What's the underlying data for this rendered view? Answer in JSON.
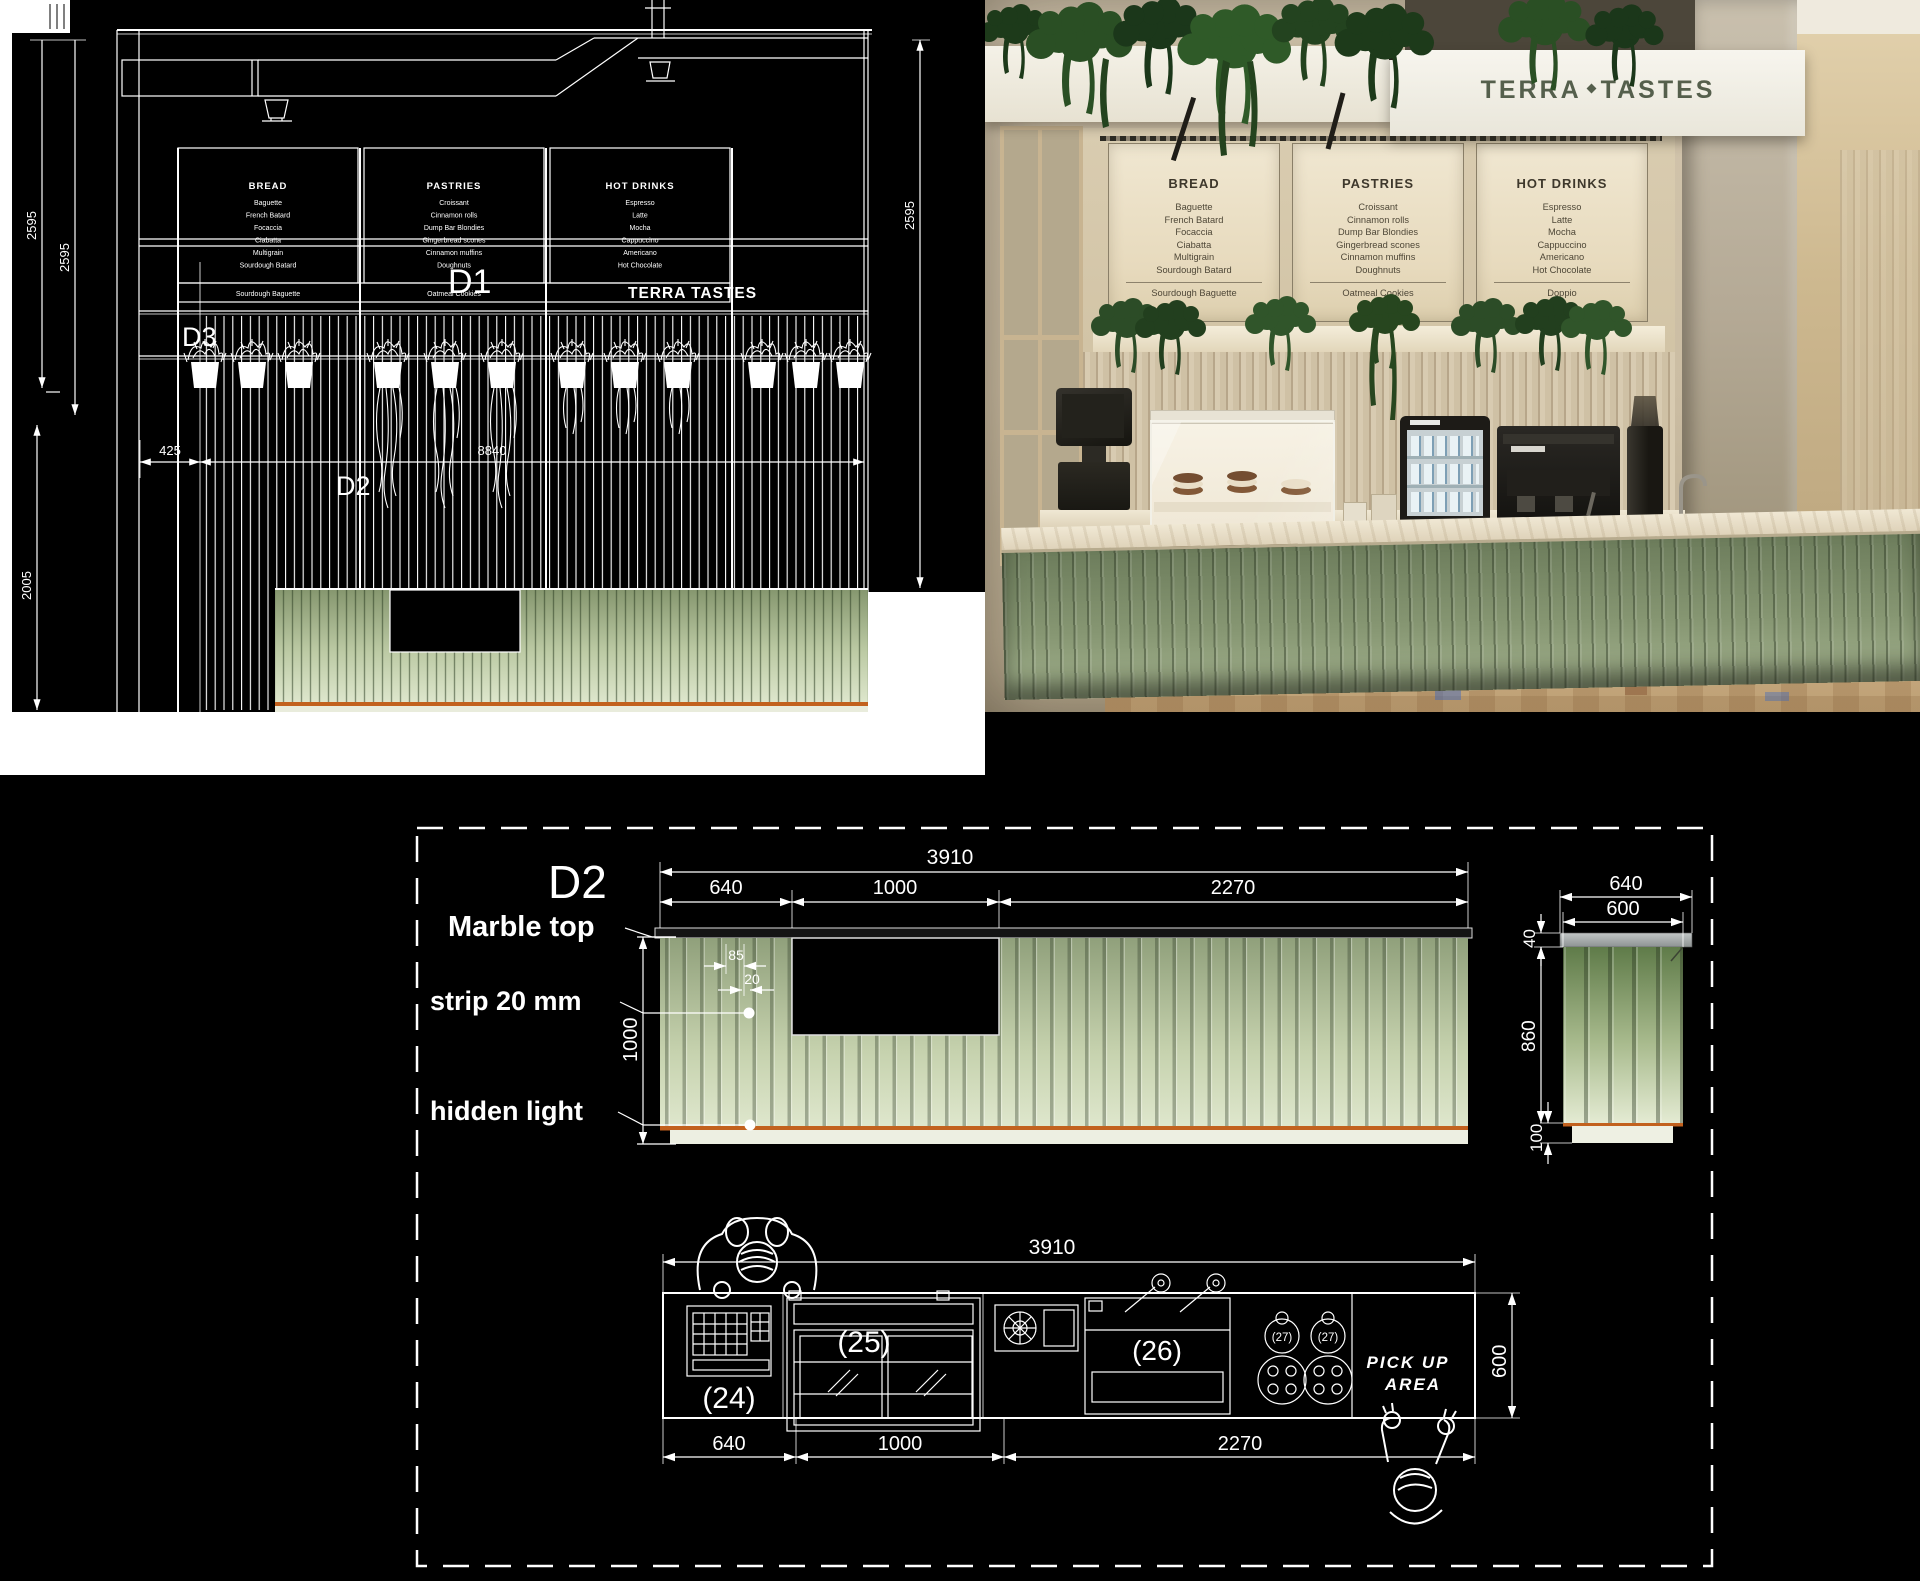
{
  "cad": {
    "brand": "TERRA TASTES",
    "labels": {
      "d1": "D1",
      "d2": "D2",
      "d3": "D3"
    },
    "dims": {
      "height_a": "2595",
      "height_b": "2595",
      "height_lower": "2005",
      "height_right": "2595",
      "offset": "425",
      "total_width": "8840"
    },
    "menu": {
      "boards": [
        {
          "title": "BREAD",
          "items": [
            "Baguette",
            "French Batard",
            "Focaccia",
            "Ciabatta",
            "Multigrain",
            "Sourdough Batard"
          ],
          "bottom": "Sourdough Baguette"
        },
        {
          "title": "PASTRIES",
          "items": [
            "Croissant",
            "Cinnamon rolls",
            "Dump Bar Blondies",
            "Gingerbread scones",
            "Cinnamon muffins",
            "Doughnuts"
          ],
          "bottom": "Oatmeal Cookies"
        },
        {
          "title": "HOT DRINKS",
          "items": [
            "Espresso",
            "Latte",
            "Mocha",
            "Cappuccino",
            "Americano",
            "Hot Chocolate"
          ],
          "bottom": ""
        }
      ]
    }
  },
  "render": {
    "brand_left": "TERRA",
    "brand_right": "TASTES",
    "menu": {
      "boards": [
        {
          "title": "BREAD",
          "items": [
            "Baguette",
            "French Batard",
            "Focaccia",
            "Ciabatta",
            "Multigrain",
            "Sourdough Batard",
            "Sourdough Baguette"
          ]
        },
        {
          "title": "PASTRIES",
          "items": [
            "Croissant",
            "Cinnamon rolls",
            "Dump Bar Blondies",
            "Gingerbread scones",
            "Cinnamon muffins",
            "Doughnuts",
            "Oatmeal Cookies"
          ]
        },
        {
          "title": "HOT DRINKS",
          "items": [
            "Espresso",
            "Latte",
            "Mocha",
            "Cappuccino",
            "Americano",
            "Hot Chocolate",
            "Doppio"
          ]
        }
      ]
    }
  },
  "d2": {
    "label": "D2",
    "annotations": {
      "marble_top": "Marble top",
      "strip": "strip 20 mm",
      "hidden_light": "hidden light"
    },
    "elevation": {
      "total": "3910",
      "seg_left": "640",
      "seg_mid": "1000",
      "seg_right": "2270",
      "rib_spacing": "85",
      "strip_width": "20",
      "height": "1000"
    },
    "section": {
      "top_width": "640",
      "body_width": "600",
      "top_thickness": "40",
      "body_height": "860",
      "base_height": "100"
    },
    "plan": {
      "total": "3910",
      "seg_left": "640",
      "seg_mid": "1000",
      "seg_right": "2270",
      "depth": "600",
      "eq_24": "(24)",
      "eq_25": "(25)",
      "eq_26": "(26)",
      "eq_27a": "(27)",
      "eq_27b": "(27)",
      "pickup_line1": "PICK UP",
      "pickup_line2": "AREA"
    }
  }
}
